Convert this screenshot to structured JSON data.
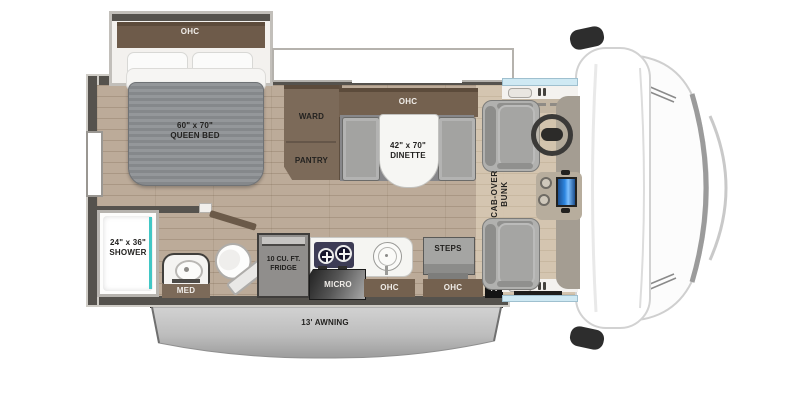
{
  "floorplan": {
    "bedroom": {
      "ohc": "OHC",
      "bed_size": "60\" x 70\"",
      "bed_name": "QUEEN BED"
    },
    "storage": {
      "ward": "WARD",
      "pantry": "PANTRY"
    },
    "dinette": {
      "ohc": "OHC",
      "size": "42\" x 70\"",
      "name": "DINETTE"
    },
    "cab": {
      "bunk_line1": "CAB-OVER",
      "bunk_line2": "BUNK"
    },
    "bathroom": {
      "shower_size": "24\" x 36\"",
      "shower_name": "SHOWER",
      "med": "MED"
    },
    "kitchen": {
      "fridge_size": "10 CU. FT.",
      "fridge_name": "FRIDGE",
      "micro": "MICRO",
      "ohc": "OHC"
    },
    "entry": {
      "steps": "STEPS",
      "ohc": "OHC",
      "tv": "TV"
    },
    "exterior": {
      "awning": "13' AWNING"
    },
    "colors": {
      "floor": "#bcab99",
      "cabinet": "#74614f",
      "cabinet_dark": "#5c4b3b",
      "wall": "#55524d",
      "mattress": "#8a8d90",
      "seat_gray": "#a5a5a3",
      "accent_teal": "#41c7c5",
      "screen_blue": "#2e86e0",
      "cooktop_navy": "#3d3c55",
      "awning_gray": "#b3b3b3"
    }
  }
}
